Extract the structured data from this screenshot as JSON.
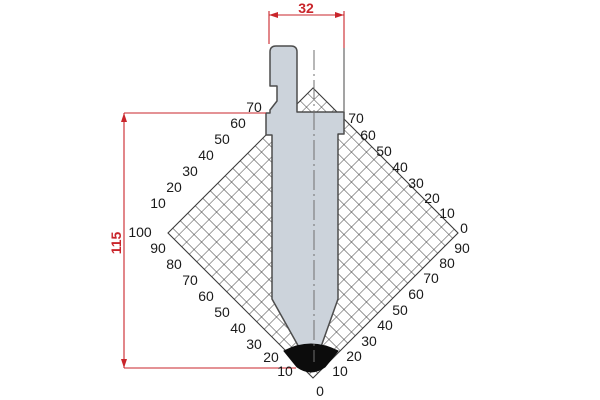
{
  "drawing": {
    "title": "punch-profile-technical-drawing",
    "dimensions": {
      "width": "32",
      "height": "115"
    },
    "grid_labels": [
      {
        "t": "70",
        "x": 254,
        "y": 107
      },
      {
        "t": "60",
        "x": 238,
        "y": 123
      },
      {
        "t": "50",
        "x": 222,
        "y": 139
      },
      {
        "t": "40",
        "x": 206,
        "y": 155
      },
      {
        "t": "30",
        "x": 190,
        "y": 171
      },
      {
        "t": "20",
        "x": 174,
        "y": 187
      },
      {
        "t": "10",
        "x": 158,
        "y": 203
      },
      {
        "t": "100",
        "x": 140,
        "y": 232
      },
      {
        "t": "90",
        "x": 158,
        "y": 248
      },
      {
        "t": "80",
        "x": 174,
        "y": 264
      },
      {
        "t": "70",
        "x": 190,
        "y": 280
      },
      {
        "t": "60",
        "x": 206,
        "y": 296
      },
      {
        "t": "50",
        "x": 222,
        "y": 312
      },
      {
        "t": "40",
        "x": 238,
        "y": 328
      },
      {
        "t": "30",
        "x": 254,
        "y": 344
      },
      {
        "t": "20",
        "x": 271,
        "y": 357
      },
      {
        "t": "10",
        "x": 285,
        "y": 371
      },
      {
        "t": "0",
        "x": 320,
        "y": 391
      },
      {
        "t": "10",
        "x": 340,
        "y": 371
      },
      {
        "t": "20",
        "x": 354,
        "y": 356
      },
      {
        "t": "30",
        "x": 369,
        "y": 341
      },
      {
        "t": "40",
        "x": 385,
        "y": 325
      },
      {
        "t": "50",
        "x": 400,
        "y": 310
      },
      {
        "t": "60",
        "x": 416,
        "y": 294
      },
      {
        "t": "70",
        "x": 431,
        "y": 278
      },
      {
        "t": "80",
        "x": 447,
        "y": 263
      },
      {
        "t": "90",
        "x": 462,
        "y": 248
      },
      {
        "t": "0",
        "x": 464,
        "y": 228
      },
      {
        "t": "10",
        "x": 447,
        "y": 213
      },
      {
        "t": "20",
        "x": 432,
        "y": 198
      },
      {
        "t": "30",
        "x": 416,
        "y": 183
      },
      {
        "t": "40",
        "x": 400,
        "y": 167
      },
      {
        "t": "50",
        "x": 384,
        "y": 151
      },
      {
        "t": "60",
        "x": 368,
        "y": 135
      },
      {
        "t": "70",
        "x": 356,
        "y": 118
      }
    ],
    "colors": {
      "dimension_red": "#c9252b",
      "tool_fill": "#ccd3db",
      "tool_outline": "#4d4d4d",
      "grid_line": "#3a3a3a",
      "tip_black": "#0c0c0c",
      "label_text": "#1a1a1a"
    }
  }
}
